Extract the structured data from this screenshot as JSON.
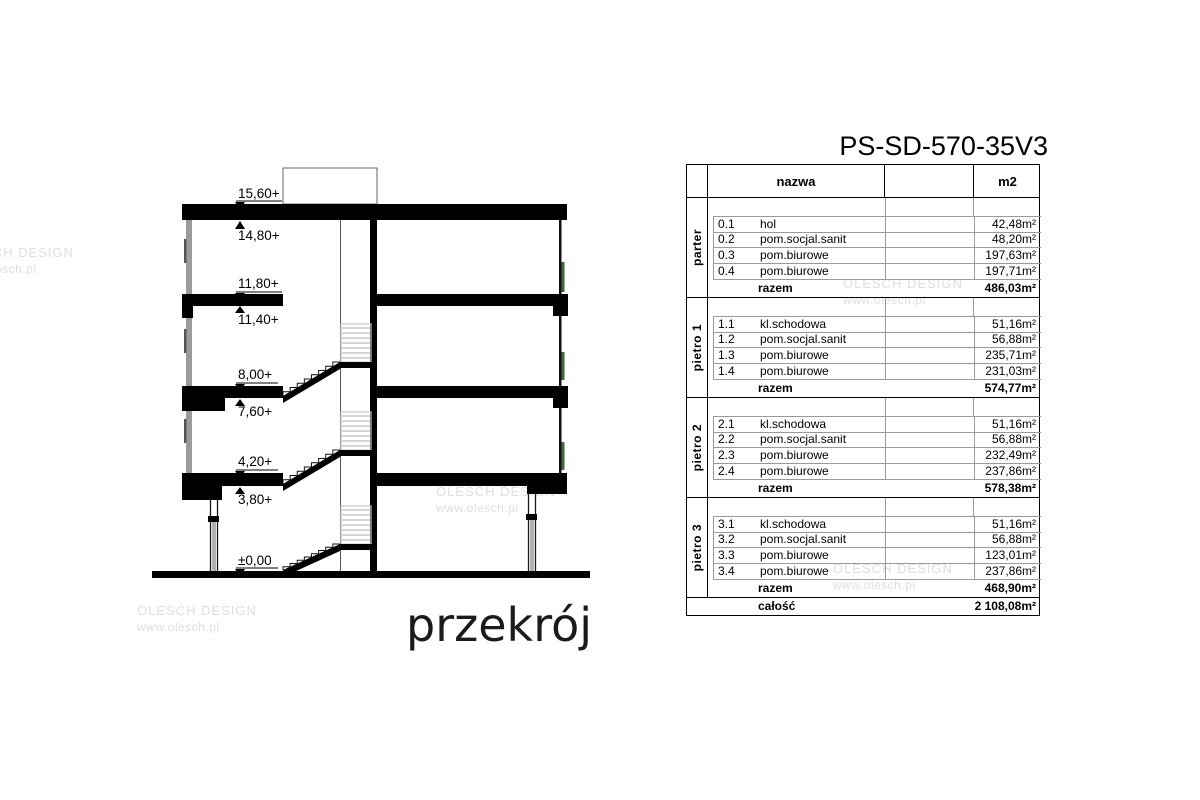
{
  "colors": {
    "window_green": "#3e6b38"
  },
  "title": "PS-SD-570-35V3",
  "drawing": {
    "label": "przekrój",
    "elevations": [
      "15,60+",
      "14,80+",
      "11,80+",
      "11,40+",
      "8,00+",
      "7,60+",
      "4,20+",
      "3,80+",
      "±0,00"
    ]
  },
  "watermark": {
    "line1": "OLESCH DESIGN",
    "line2": "www.olesch.pl"
  },
  "table": {
    "headers": {
      "name": "nazwa",
      "area": "m2"
    },
    "razem_label": "razem",
    "total_label": "całość",
    "total_area": "2 108,08m²",
    "groups": [
      {
        "label": "parter",
        "razem": "486,03m²",
        "rows": [
          {
            "no": "0.1",
            "name": "hol",
            "area": "42,48m²"
          },
          {
            "no": "0.2",
            "name": "pom.socjal.sanit",
            "area": "48,20m²"
          },
          {
            "no": "0.3",
            "name": "pom.biurowe",
            "area": "197,63m²"
          },
          {
            "no": "0.4",
            "name": "pom.biurowe",
            "area": "197,71m²"
          }
        ]
      },
      {
        "label": "pietro 1",
        "razem": "574,77m²",
        "rows": [
          {
            "no": "1.1",
            "name": "kl.schodowa",
            "area": "51,16m²"
          },
          {
            "no": "1.2",
            "name": "pom.socjal.sanit",
            "area": "56,88m²"
          },
          {
            "no": "1.3",
            "name": "pom.biurowe",
            "area": "235,71m²"
          },
          {
            "no": "1.4",
            "name": "pom.biurowe",
            "area": "231,03m²"
          }
        ]
      },
      {
        "label": "pietro 2",
        "razem": "578,38m²",
        "rows": [
          {
            "no": "2.1",
            "name": "kl.schodowa",
            "area": "51,16m²"
          },
          {
            "no": "2.2",
            "name": "pom.socjal.sanit",
            "area": "56,88m²"
          },
          {
            "no": "2.3",
            "name": "pom.biurowe",
            "area": "232,49m²"
          },
          {
            "no": "2.4",
            "name": "pom.biurowe",
            "area": "237,86m²"
          }
        ]
      },
      {
        "label": "pietro 3",
        "razem": "468,90m²",
        "rows": [
          {
            "no": "3.1",
            "name": "kl.schodowa",
            "area": "51,16m²"
          },
          {
            "no": "3.2",
            "name": "pom.socjal.sanit",
            "area": "56,88m²"
          },
          {
            "no": "3.3",
            "name": "pom.biurowe",
            "area": "123,01m²"
          },
          {
            "no": "3.4",
            "name": "pom.biurowe",
            "area": "237,86m²"
          }
        ]
      }
    ]
  }
}
